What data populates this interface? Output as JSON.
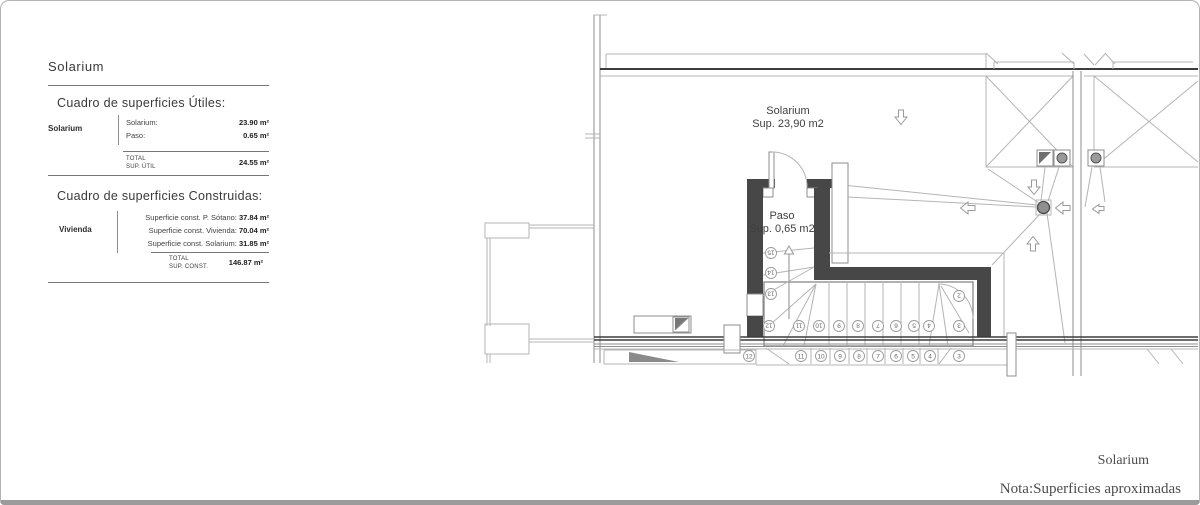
{
  "panel": {
    "title": "Solarium",
    "utiles": {
      "heading": "Cuadro de superficies Útiles:",
      "row_label": "Solarium",
      "rows": [
        {
          "label": "Solarium:",
          "value": "23.90 m²"
        },
        {
          "label": "Paso:",
          "value": "0.65 m²"
        }
      ],
      "total_label_1": "TOTAL",
      "total_label_2": "SUP. ÚTIL",
      "total_value": "24.55 m²"
    },
    "construidas": {
      "heading": "Cuadro de superficies Construidas:",
      "row_label": "Vivienda",
      "rows": [
        {
          "label": "Superficie const. P. Sótano: ",
          "value": "37.84 m²"
        },
        {
          "label": "Superficie const. Vivienda: ",
          "value": "70.04 m²"
        },
        {
          "label": "Superficie const. Solarium: ",
          "value": "31.85 m²"
        }
      ],
      "total_label_1": "TOTAL",
      "total_label_2": "SUP. CONST.",
      "total_value": "146.87 m²"
    }
  },
  "plan": {
    "room_label_1": "Solarium",
    "room_label_2": "Sup. 23,90 m2",
    "paso_label_1": "Paso",
    "paso_label_2": "Sup. 0,65 m2",
    "upper_steps": [
      "15",
      "14",
      "13",
      "12",
      "11",
      "10",
      "9",
      "8",
      "7",
      "6",
      "5",
      "4",
      "3",
      "2"
    ],
    "lower_steps": [
      "12",
      "11",
      "10",
      "9",
      "8",
      "7",
      "6",
      "5",
      "4",
      "3"
    ]
  },
  "footer": {
    "sheet_title": "Solarium",
    "note": "Nota:Superficies aproximadas"
  },
  "colors": {
    "wall": "#474747",
    "line_light": "#b4b4b4",
    "line_mid": "#8e8e8e",
    "section_band": "#3d3d3d",
    "gray_fill": "#8a8a8a",
    "panel_text": "#3a3a3a",
    "footer_text": "#4d4d4d"
  }
}
